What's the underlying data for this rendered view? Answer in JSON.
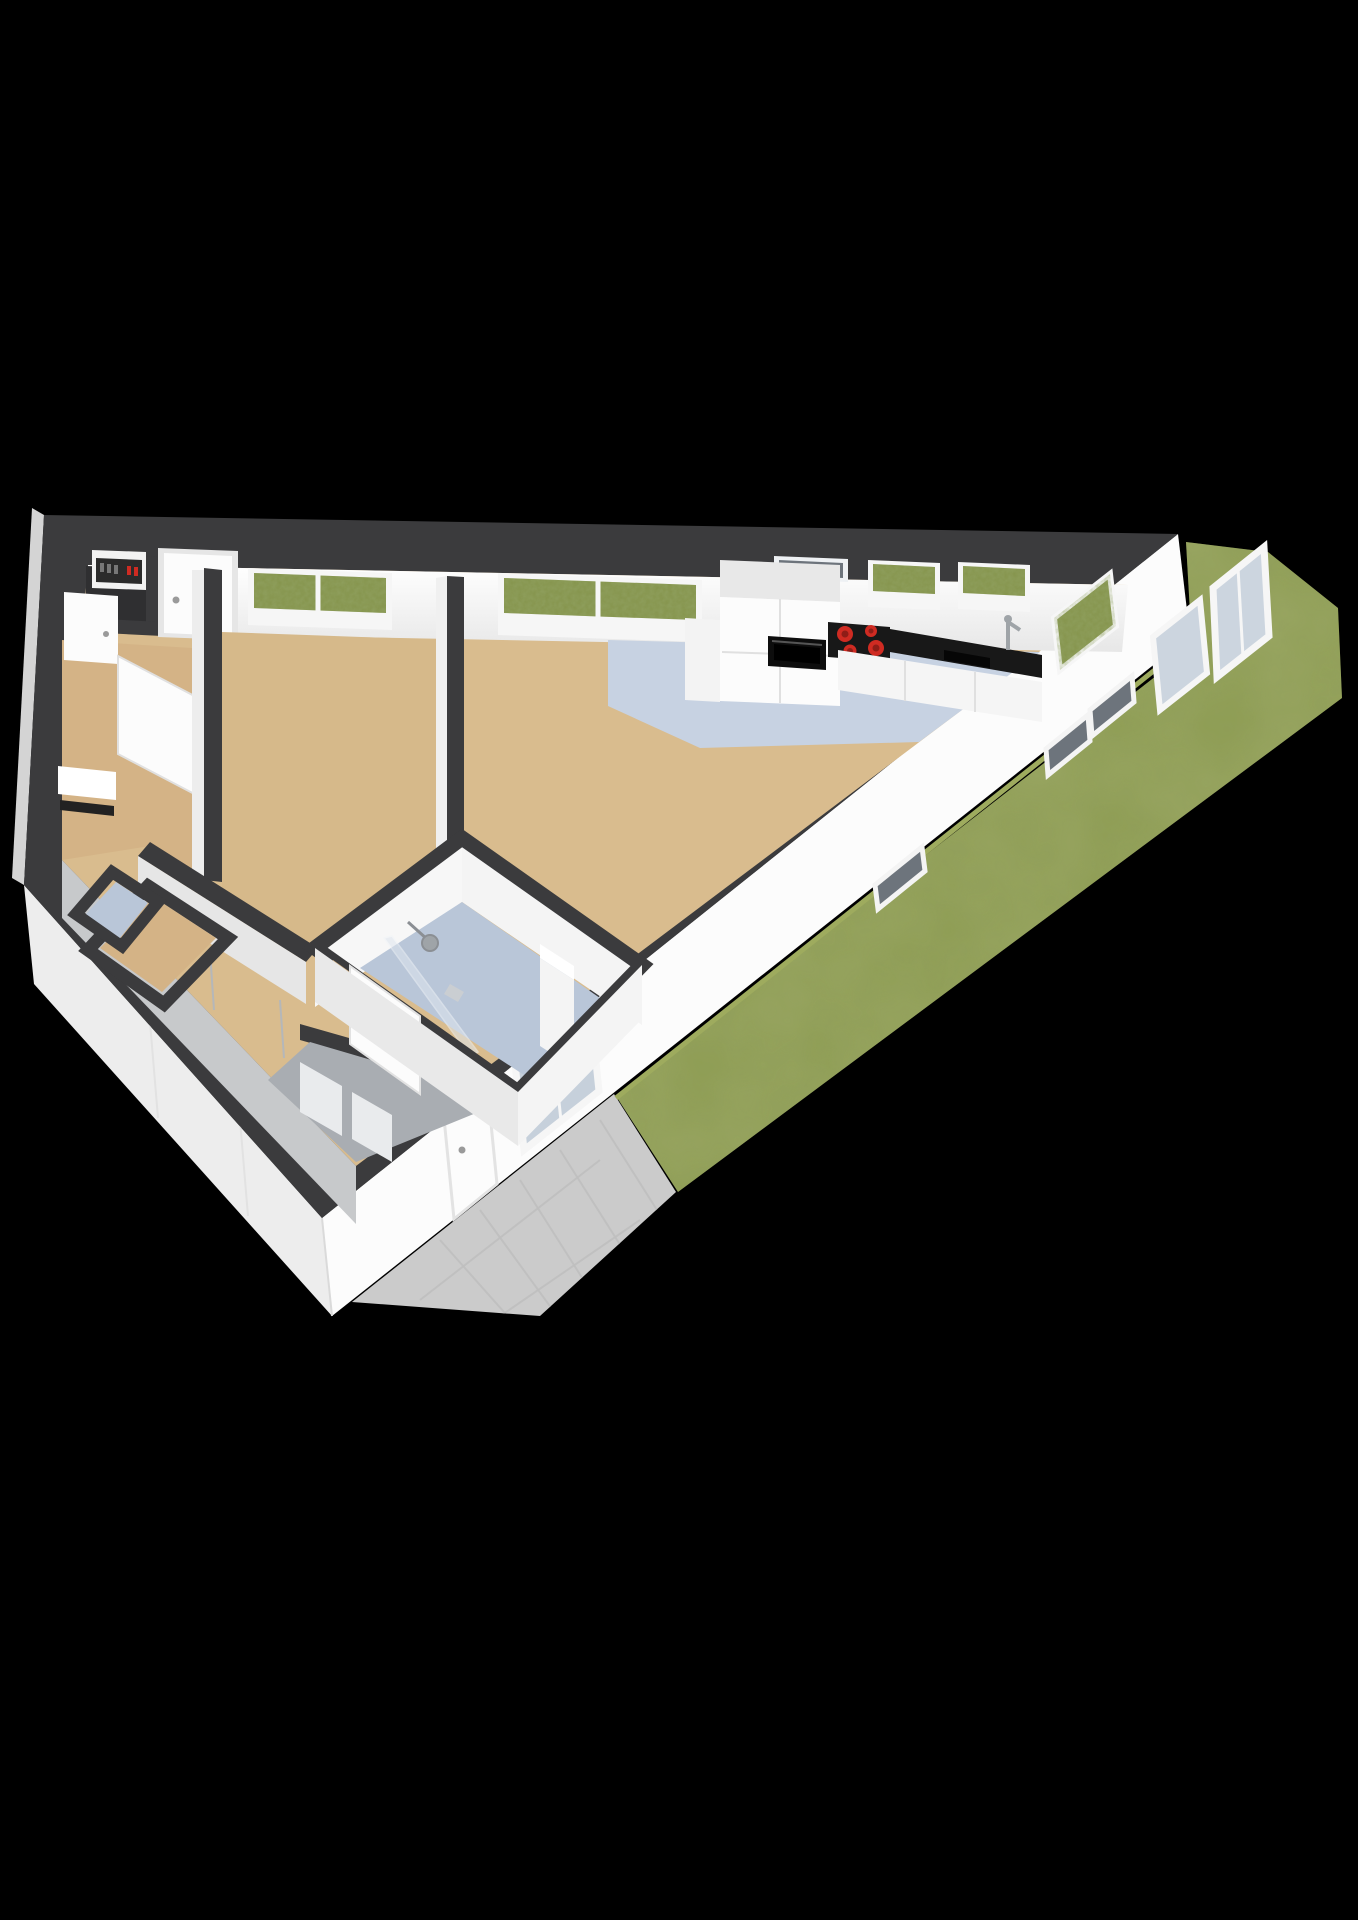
{
  "scene": {
    "title": "3D floor plan rendering of a one-bedroom apartment with garden",
    "view": "isometric-cutaway",
    "background": "#000000"
  },
  "colors": {
    "background": "#000000",
    "wall_top": "#3b3b3d",
    "wall_face": "#fcfcfc",
    "wall_face_shade": "#ededed",
    "wall_face_dark": "#d4d4d4",
    "interior_face": "#f4f4f4",
    "interior_gray_face": "#c7c9cb",
    "floor_living": "#d9bc8e",
    "floor_bedroom": "#d6b98a",
    "floor_hall": "#d4b386",
    "floor_kitchen": "#c7d2e2",
    "floor_bath": "#b9c6d8",
    "floor_utility": "#a9adb2",
    "floor_closet_dark": "#2f2f31",
    "grass": "#8d9c52",
    "grass_edge_line": "#9eab5e",
    "patio": "#cbcbcb",
    "counter_black": "#181818",
    "oven_black": "#0d0d0d",
    "burner_red": "#cf2b22",
    "burner_red_dark": "#8f1d17",
    "glass_blue": "#ccd5df",
    "glass_bath": "#c6d0db",
    "window_green": "#85944c",
    "slit_dark": "#6d747c",
    "door_white": "#fcfcfc",
    "frame_white": "#f6f6f6",
    "metal_gray": "#9fa4a8",
    "panel_dark": "#2b2b2b",
    "column_white": "#f4f4f4",
    "shelf_white": "#ffffff"
  },
  "rooms": [
    {
      "id": "living-room",
      "floor_style": "tan"
    },
    {
      "id": "kitchen",
      "floor_style": "blue-gray"
    },
    {
      "id": "bedroom",
      "floor_style": "tan"
    },
    {
      "id": "hallway",
      "floor_style": "tan"
    },
    {
      "id": "bathroom",
      "floor_style": "blue-gray"
    },
    {
      "id": "meter-closet",
      "floor_style": "dark"
    },
    {
      "id": "storage-closet",
      "floor_style": "tan"
    },
    {
      "id": "storage-closet-small",
      "floor_style": "blue-gray"
    },
    {
      "id": "utility-corner",
      "floor_style": "gray"
    }
  ],
  "exterior": {
    "garden": "lawn-wrapping-right-side",
    "patio": "tiled-triangle-at-lower-wall",
    "hedge_visible_through_windows": true
  },
  "kitchen": {
    "burner_count": 4,
    "appliances": [
      "tall-cabinet",
      "oven",
      "cooktop",
      "countertop",
      "sink",
      "faucet",
      "base-cabinets"
    ]
  },
  "bathroom": {
    "fixtures": [
      "shower-head",
      "glass-screen",
      "tall-column",
      "door"
    ]
  },
  "openings": {
    "top_wall": [
      "front-door",
      "window",
      "window",
      "slit-window",
      "window",
      "window"
    ],
    "right_wall": [
      "corner-window",
      "window",
      "window",
      "slit-window",
      "slit-window",
      "slit-window",
      "bathroom-window",
      "garden-door"
    ],
    "interior_doors": [
      "hall-side-door",
      "bedroom-door",
      "bathroom-door"
    ]
  }
}
